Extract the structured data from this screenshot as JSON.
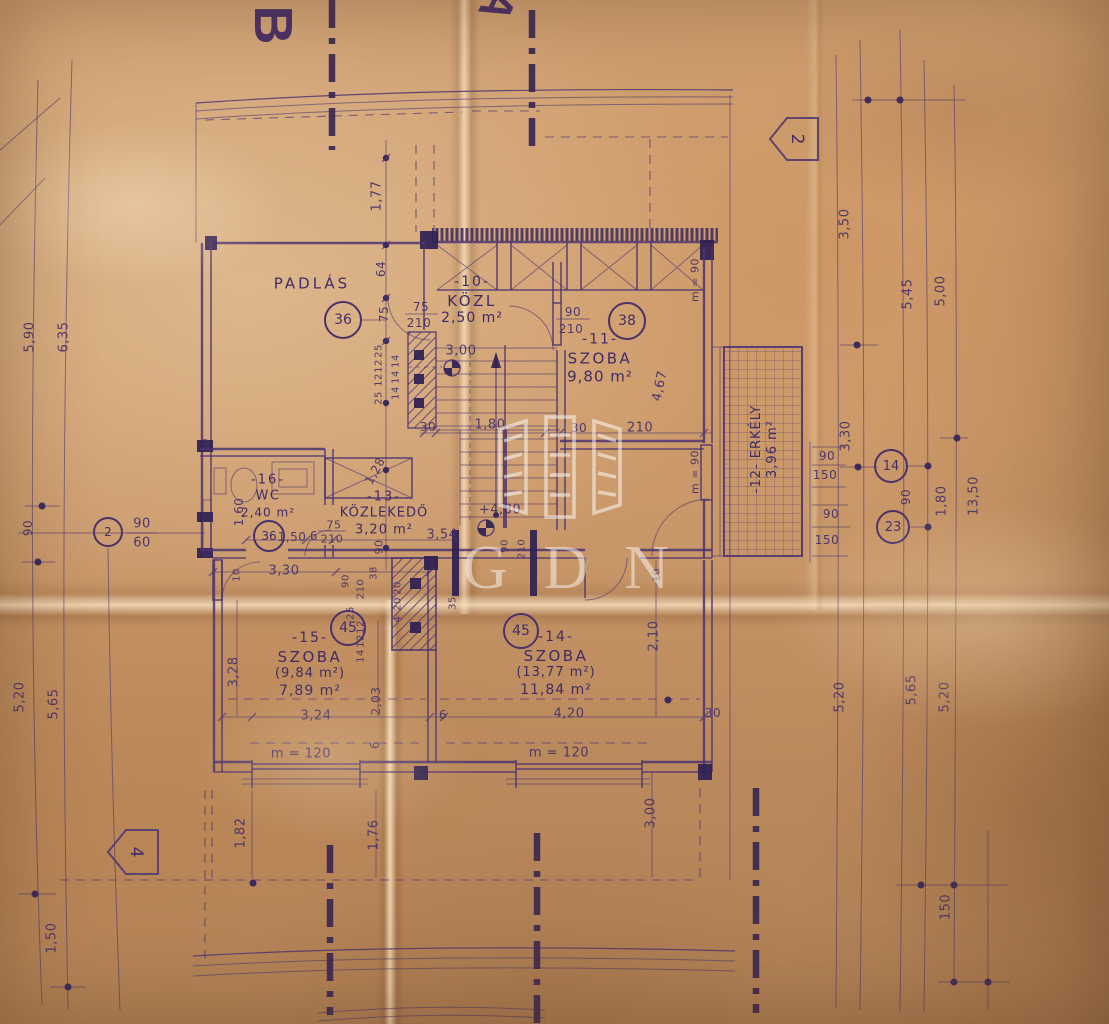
{
  "sheet": {
    "corner_letter_top": "B",
    "corner_letter_top_right": "A",
    "watermark": "GDN"
  },
  "rooms": [
    {
      "number": "-10-",
      "name": "KÖZL",
      "area": "2,50 m²"
    },
    {
      "number": "-11-",
      "name": "SZOBA",
      "area": "9,80 m²"
    },
    {
      "number": "-12-",
      "name": "ERKÉLY",
      "area": "3,96 m²"
    },
    {
      "number": "-13-",
      "name": "KÖZLEKEDŐ",
      "area": "3,20 m²"
    },
    {
      "number": "-14-",
      "name": "SZOBA",
      "area_gross": "(13,77 m²)",
      "area": "11,84 m²"
    },
    {
      "number": "-15-",
      "name": "SZOBA",
      "area_gross": "(9,84 m²)",
      "area": "7,89 m²"
    },
    {
      "number": "-16-",
      "name": "WC",
      "area": "2,40 m²"
    },
    {
      "attic": "PADLÁS"
    }
  ],
  "markers": {
    "circles": [
      "36",
      "38",
      "36",
      "45",
      "45",
      "2",
      "14",
      "23"
    ],
    "pentagons": [
      "2",
      "4"
    ]
  },
  "colors": {
    "ink": "#4a3169",
    "paper": "#c79468"
  },
  "dims": [
    {
      "t": "5,90",
      "x": 30,
      "y": 337,
      "r": -90
    },
    {
      "t": "6,35",
      "x": 64,
      "y": 337,
      "r": -90
    },
    {
      "t": "90",
      "x": 28,
      "y": 528,
      "r": -90,
      "fs": 12
    },
    {
      "t": "90",
      "x": 142,
      "y": 524,
      "fs": 13
    },
    {
      "t": "60",
      "x": 142,
      "y": 543,
      "fs": 13
    },
    {
      "t": "5,20",
      "x": 20,
      "y": 697,
      "r": -90
    },
    {
      "t": "5,65",
      "x": 54,
      "y": 704,
      "r": -90
    },
    {
      "t": "1,50",
      "x": 52,
      "y": 938,
      "r": -90
    },
    {
      "t": "3,50",
      "x": 845,
      "y": 224,
      "r": -90
    },
    {
      "t": "5,45",
      "x": 908,
      "y": 294,
      "r": -90
    },
    {
      "t": "5,00",
      "x": 941,
      "y": 291,
      "r": -90
    },
    {
      "t": "3,30",
      "x": 846,
      "y": 436,
      "r": -90
    },
    {
      "t": "90",
      "x": 827,
      "y": 456,
      "fs": 12
    },
    {
      "t": "150",
      "x": 825,
      "y": 475,
      "fs": 12
    },
    {
      "t": "90",
      "x": 831,
      "y": 514,
      "fs": 12
    },
    {
      "t": "150",
      "x": 827,
      "y": 540,
      "fs": 12
    },
    {
      "t": "90",
      "x": 906,
      "y": 497,
      "r": -90,
      "fs": 12
    },
    {
      "t": "1,80",
      "x": 942,
      "y": 501,
      "r": -90
    },
    {
      "t": "13,50",
      "x": 974,
      "y": 496,
      "r": -90
    },
    {
      "t": "5,20",
      "x": 840,
      "y": 697,
      "r": -90
    },
    {
      "t": "5,65",
      "x": 912,
      "y": 690,
      "r": -90
    },
    {
      "t": "5,20",
      "x": 945,
      "y": 697,
      "r": -90
    },
    {
      "t": "150",
      "x": 946,
      "y": 907,
      "r": -90
    },
    {
      "t": "1,77",
      "x": 377,
      "y": 196,
      "r": -90
    },
    {
      "t": "64",
      "x": 381,
      "y": 269,
      "r": -90,
      "fs": 12
    },
    {
      "t": "75",
      "x": 384,
      "y": 314,
      "r": -90,
      "fs": 12
    },
    {
      "t": "75",
      "x": 421,
      "y": 307,
      "fs": 12
    },
    {
      "t": "210",
      "x": 419,
      "y": 323,
      "fs": 12
    },
    {
      "t": "25",
      "x": 379,
      "y": 351,
      "r": -90,
      "fs": 10
    },
    {
      "t": "12",
      "x": 379,
      "y": 366,
      "r": -90,
      "fs": 10
    },
    {
      "t": "12",
      "x": 379,
      "y": 380,
      "r": -90,
      "fs": 10
    },
    {
      "t": "25",
      "x": 379,
      "y": 398,
      "r": -90,
      "fs": 10
    },
    {
      "t": "14",
      "x": 396,
      "y": 361,
      "r": -90,
      "fs": 10
    },
    {
      "t": "14",
      "x": 396,
      "y": 377,
      "r": -90,
      "fs": 10
    },
    {
      "t": "14",
      "x": 396,
      "y": 393,
      "r": -90,
      "fs": 10
    },
    {
      "t": "3,30",
      "x": 284,
      "y": 571
    },
    {
      "t": "10",
      "x": 206,
      "y": 445,
      "r": -90,
      "fs": 10
    },
    {
      "t": "30",
      "x": 428,
      "y": 427,
      "fs": 12
    },
    {
      "t": "1,80",
      "x": 490,
      "y": 425
    },
    {
      "t": "30",
      "x": 579,
      "y": 428,
      "fs": 12
    },
    {
      "t": "210",
      "x": 640,
      "y": 428
    },
    {
      "t": "3,00",
      "x": 461,
      "y": 351
    },
    {
      "t": "90",
      "x": 573,
      "y": 312,
      "fs": 12
    },
    {
      "t": "210",
      "x": 571,
      "y": 329,
      "fs": 12
    },
    {
      "t": "4,67",
      "x": 660,
      "y": 386,
      "r": -78
    },
    {
      "t": "m = 90",
      "x": 695,
      "y": 280,
      "r": -90,
      "fs": 11
    },
    {
      "t": "m = 90",
      "x": 695,
      "y": 472,
      "r": -90,
      "fs": 11
    },
    {
      "t": "1,60",
      "x": 239,
      "y": 512,
      "r": -90,
      "fs": 12
    },
    {
      "t": "1,50",
      "x": 292,
      "y": 537,
      "fs": 12
    },
    {
      "t": "6",
      "x": 314,
      "y": 536,
      "fs": 12
    },
    {
      "t": "75",
      "x": 334,
      "y": 525,
      "fs": 11
    },
    {
      "t": "210",
      "x": 332,
      "y": 539,
      "fs": 11
    },
    {
      "t": "1,28",
      "x": 375,
      "y": 471,
      "r": -62,
      "fs": 12
    },
    {
      "t": "3,54",
      "x": 442,
      "y": 535
    },
    {
      "t": "90",
      "x": 379,
      "y": 547,
      "r": -90,
      "fs": 11
    },
    {
      "t": "10",
      "x": 237,
      "y": 575,
      "r": -90,
      "fs": 10
    },
    {
      "t": "10",
      "x": 657,
      "y": 575,
      "r": -90,
      "fs": 10
    },
    {
      "t": "+4,80",
      "x": 500,
      "y": 510
    },
    {
      "t": "90",
      "x": 346,
      "y": 581,
      "r": -90,
      "fs": 10
    },
    {
      "t": "210",
      "x": 361,
      "y": 589,
      "r": -90,
      "fs": 10
    },
    {
      "t": "38",
      "x": 374,
      "y": 573,
      "r": -90,
      "fs": 10
    },
    {
      "t": "20",
      "x": 398,
      "y": 588,
      "r": -90,
      "fs": 10
    },
    {
      "t": "25",
      "x": 351,
      "y": 613,
      "r": -90,
      "fs": 10
    },
    {
      "t": "35",
      "x": 453,
      "y": 603,
      "r": -90,
      "fs": 10
    },
    {
      "t": "90",
      "x": 505,
      "y": 546,
      "r": -90,
      "fs": 10
    },
    {
      "t": "210",
      "x": 522,
      "y": 549,
      "r": -90,
      "fs": 10
    },
    {
      "t": "12",
      "x": 361,
      "y": 627,
      "r": -90,
      "fs": 10
    },
    {
      "t": "12",
      "x": 361,
      "y": 641,
      "r": -90,
      "fs": 10
    },
    {
      "t": "14",
      "x": 361,
      "y": 656,
      "r": -90,
      "fs": 10
    },
    {
      "t": "20",
      "x": 398,
      "y": 604,
      "r": -90,
      "fs": 10
    },
    {
      "t": "4",
      "x": 398,
      "y": 619,
      "r": -90,
      "fs": 10
    },
    {
      "t": "3,28",
      "x": 234,
      "y": 672,
      "r": -90
    },
    {
      "t": "3,24",
      "x": 316,
      "y": 716
    },
    {
      "t": "2,03",
      "x": 376,
      "y": 701,
      "r": -90,
      "fs": 12
    },
    {
      "t": "6",
      "x": 375,
      "y": 745,
      "r": -90,
      "fs": 12
    },
    {
      "t": "6",
      "x": 443,
      "y": 715,
      "fs": 12
    },
    {
      "t": "m = 120",
      "x": 301,
      "y": 754
    },
    {
      "t": "m = 120",
      "x": 559,
      "y": 753
    },
    {
      "t": "4,20",
      "x": 569,
      "y": 714
    },
    {
      "t": "30",
      "x": 713,
      "y": 713,
      "fs": 12
    },
    {
      "t": "2,10",
      "x": 654,
      "y": 636,
      "r": -90
    },
    {
      "t": "1,82",
      "x": 241,
      "y": 833,
      "r": -90
    },
    {
      "t": "1,76",
      "x": 374,
      "y": 835,
      "r": -90
    },
    {
      "t": "3,00",
      "x": 651,
      "y": 813,
      "r": -90
    }
  ]
}
